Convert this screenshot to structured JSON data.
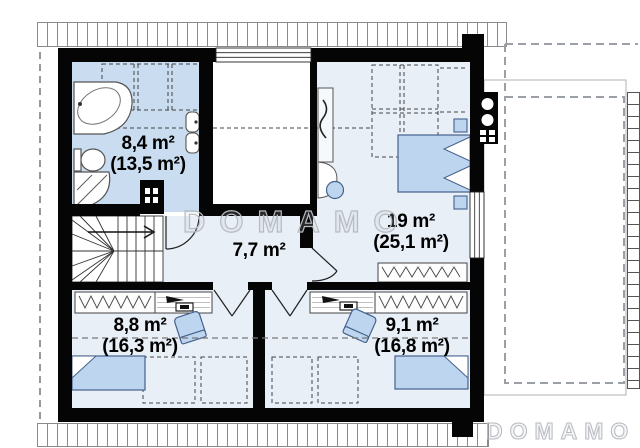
{
  "watermark": {
    "center": "DOMAMO",
    "bottom_right": "DOMAMO"
  },
  "rooms": {
    "bathroom": {
      "area": "8,4 m²",
      "total": "(13,5 m²)"
    },
    "hall": {
      "area": "7,7 m²"
    },
    "bedroom": {
      "area": "19 m²",
      "total": "(25,1 m²)"
    },
    "bedroom_small_left": {
      "area": "8,8 m²",
      "total": "(16,3 m²)"
    },
    "bedroom_small_right": {
      "area": "9,1 m²",
      "total": "(16,8 m²)"
    }
  },
  "colors": {
    "wall": "#050505",
    "bathroom_floor": "#c9dcf0",
    "room_floor": "#e9eff7",
    "furniture_fill": "#bdd5ee",
    "furniture_stroke": "#44618c",
    "watermark_outline": "#b7bac1",
    "roof_dash": "#9aa0a6"
  },
  "fixtures": [
    "corner-bathtub",
    "toilet",
    "shower",
    "washbasin",
    "staircase",
    "chimney",
    "skylight",
    "double-bed",
    "single-bed",
    "nightstand",
    "wardrobe",
    "desk",
    "office-chair",
    "window",
    "balcony-roof"
  ]
}
